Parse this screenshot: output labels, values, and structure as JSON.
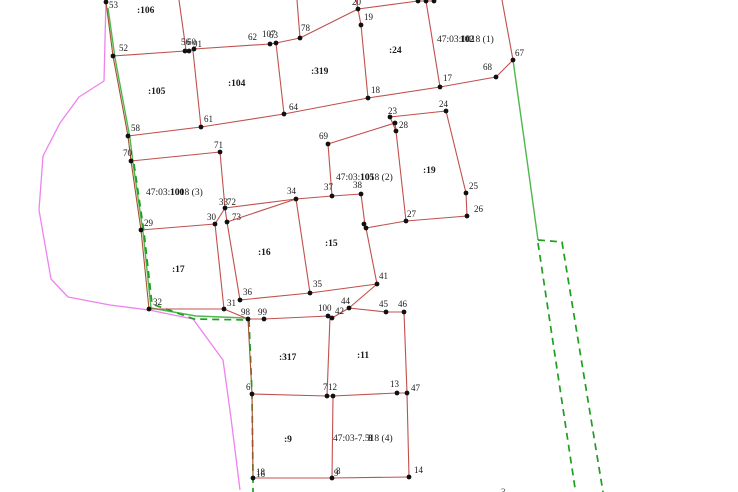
{
  "map": {
    "width": 738,
    "height": 492,
    "colors": {
      "parcel_line": "#c0504d",
      "parcel_line_brown": "#a85032",
      "vertex_dot": "#101010",
      "green_solid": "#4db84d",
      "green_dashed": "#1f9e1f",
      "magenta": "#ee82ee",
      "label_text": "#1a1a1a"
    },
    "red_polylines": [
      {
        "c": "brown",
        "pts": [
          [
            105,
            0
          ],
          [
            106,
            2
          ],
          [
            113,
            56
          ],
          [
            128,
            136
          ],
          [
            131,
            161
          ],
          [
            141,
            230
          ],
          [
            149,
            309
          ]
        ]
      },
      {
        "pts": [
          [
            113,
            56
          ],
          [
            185,
            51
          ],
          [
            189,
            51
          ],
          [
            194,
            49
          ],
          [
            270,
            44
          ],
          [
            276,
            43
          ],
          [
            300,
            38
          ],
          [
            358,
            9
          ],
          [
            361,
            25
          ],
          [
            368,
            98
          ],
          [
            440,
            87
          ],
          [
            496,
            77
          ],
          [
            513,
            60
          ]
        ]
      },
      {
        "pts": [
          [
            128,
            136
          ],
          [
            201,
            127
          ],
          [
            284,
            114
          ],
          [
            368,
            98
          ]
        ]
      },
      {
        "pts": [
          [
            193,
            51
          ],
          [
            201,
            127
          ]
        ]
      },
      {
        "pts": [
          [
            276,
            43
          ],
          [
            284,
            114
          ]
        ]
      },
      {
        "pts": [
          [
            186,
            50
          ],
          [
            179,
            0
          ]
        ]
      },
      {
        "pts": [
          [
            300,
            38
          ],
          [
            297,
            0
          ]
        ]
      },
      {
        "pts": [
          [
            358,
            9
          ],
          [
            356,
            0
          ]
        ]
      },
      {
        "pts": [
          [
            358,
            9
          ],
          [
            418,
            1
          ],
          [
            426,
            1
          ],
          [
            434,
            1
          ]
        ]
      },
      {
        "pts": [
          [
            426,
            1
          ],
          [
            440,
            87
          ]
        ]
      },
      {
        "pts": [
          [
            502,
            0
          ],
          [
            513,
            60
          ]
        ]
      },
      {
        "pts": [
          [
            131,
            161
          ],
          [
            220,
            152
          ],
          [
            225,
            208
          ],
          [
            227,
            222
          ]
        ]
      },
      {
        "pts": [
          [
            141,
            230
          ],
          [
            215,
            224
          ],
          [
            225,
            208
          ]
        ]
      },
      {
        "pts": [
          [
            215,
            224
          ],
          [
            224,
            309
          ]
        ]
      },
      {
        "pts": [
          [
            227,
            222
          ],
          [
            240,
            300
          ]
        ]
      },
      {
        "pts": [
          [
            225,
            208
          ],
          [
            296,
            199
          ]
        ]
      },
      {
        "pts": [
          [
            227,
            222
          ],
          [
            296,
            199
          ]
        ]
      },
      {
        "pts": [
          [
            296,
            199
          ],
          [
            310,
            293
          ]
        ]
      },
      {
        "pts": [
          [
            310,
            293
          ],
          [
            240,
            300
          ]
        ]
      },
      {
        "pts": [
          [
            149,
            309
          ],
          [
            224,
            309
          ],
          [
            248,
            319
          ]
        ]
      },
      {
        "pts": [
          [
            328,
            144
          ],
          [
            395,
            123
          ]
        ]
      },
      {
        "pts": [
          [
            395,
            123
          ],
          [
            396,
            131
          ]
        ]
      },
      {
        "pts": [
          [
            390,
            117
          ],
          [
            396,
            131
          ]
        ]
      },
      {
        "pts": [
          [
            390,
            117
          ],
          [
            446,
            111
          ],
          [
            466,
            193
          ],
          [
            467,
            216
          ],
          [
            406,
            221
          ],
          [
            366,
            228
          ]
        ]
      },
      {
        "pts": [
          [
            396,
            131
          ],
          [
            406,
            221
          ]
        ]
      },
      {
        "pts": [
          [
            328,
            144
          ],
          [
            332,
            196
          ],
          [
            361,
            194
          ],
          [
            365,
            225
          ]
        ]
      },
      {
        "pts": [
          [
            296,
            199
          ],
          [
            332,
            196
          ]
        ]
      },
      {
        "pts": [
          [
            310,
            293
          ],
          [
            377,
            284
          ],
          [
            349,
            308
          ]
        ]
      },
      {
        "pts": [
          [
            366,
            228
          ],
          [
            377,
            284
          ]
        ]
      },
      {
        "pts": [
          [
            248,
            319
          ],
          [
            264,
            319
          ],
          [
            328,
            316
          ],
          [
            332,
            318
          ],
          [
            349,
            308
          ],
          [
            386,
            312
          ],
          [
            404,
            312
          ]
        ]
      },
      {
        "pts": [
          [
            404,
            312
          ],
          [
            407,
            393
          ]
        ]
      },
      {
        "pts": [
          [
            330,
            317
          ],
          [
            327,
            396
          ]
        ]
      },
      {
        "c": "brown",
        "pts": [
          [
            248,
            319
          ],
          [
            252,
            394
          ],
          [
            253,
            478
          ]
        ]
      },
      {
        "pts": [
          [
            252,
            394
          ],
          [
            327,
            396
          ],
          [
            333,
            396
          ],
          [
            397,
            393
          ],
          [
            407,
            393
          ]
        ]
      },
      {
        "pts": [
          [
            253,
            478
          ],
          [
            332,
            478
          ],
          [
            409,
            477
          ]
        ]
      },
      {
        "pts": [
          [
            332,
            478
          ],
          [
            333,
            396
          ]
        ]
      },
      {
        "pts": [
          [
            409,
            477
          ],
          [
            407,
            393
          ]
        ]
      }
    ],
    "green_solid_polylines": [
      [
        [
          108,
          8
        ],
        [
          115,
          58
        ],
        [
          130,
          138
        ],
        [
          133,
          163
        ],
        [
          143,
          232
        ],
        [
          151,
          308
        ],
        [
          196,
          316
        ],
        [
          245,
          318
        ]
      ],
      [
        [
          513,
          60
        ],
        [
          527,
          160
        ],
        [
          538,
          240
        ]
      ]
    ],
    "green_dashed_polylines": [
      [
        [
          134,
          164
        ],
        [
          144,
          232
        ],
        [
          152,
          304
        ],
        [
          194,
          319
        ],
        [
          247,
          320
        ]
      ],
      [
        [
          249,
          320
        ],
        [
          252,
          394
        ],
        [
          253,
          478
        ],
        [
          253,
          492
        ]
      ],
      [
        [
          538,
          240
        ],
        [
          562,
          242
        ],
        [
          603,
          492
        ]
      ],
      [
        [
          538,
          243
        ],
        [
          575,
          488
        ]
      ]
    ],
    "magenta_polylines": [
      [
        [
          106,
          0
        ],
        [
          104,
          81
        ],
        [
          79,
          97
        ],
        [
          60,
          123
        ],
        [
          43,
          156
        ],
        [
          39,
          210
        ],
        [
          51,
          279
        ],
        [
          68,
          297
        ],
        [
          110,
          305
        ],
        [
          149,
          310
        ],
        [
          193,
          319
        ],
        [
          223,
          360
        ],
        [
          231,
          418
        ],
        [
          240,
          490
        ]
      ]
    ],
    "vertices": [
      [
        106,
        2
      ],
      [
        113,
        56
      ],
      [
        185,
        51
      ],
      [
        189,
        51
      ],
      [
        194,
        49
      ],
      [
        270,
        44
      ],
      [
        276,
        43
      ],
      [
        300,
        38
      ],
      [
        358,
        9
      ],
      [
        361,
        25
      ],
      [
        418,
        1
      ],
      [
        426,
        1
      ],
      [
        434,
        1
      ],
      [
        368,
        98
      ],
      [
        440,
        87
      ],
      [
        496,
        77
      ],
      [
        513,
        60
      ],
      [
        128,
        136
      ],
      [
        201,
        127
      ],
      [
        284,
        114
      ],
      [
        131,
        161
      ],
      [
        220,
        152
      ],
      [
        328,
        144
      ],
      [
        390,
        117
      ],
      [
        446,
        111
      ],
      [
        395,
        123
      ],
      [
        396,
        131
      ],
      [
        466,
        193
      ],
      [
        467,
        216
      ],
      [
        406,
        221
      ],
      [
        332,
        196
      ],
      [
        361,
        194
      ],
      [
        296,
        199
      ],
      [
        225,
        208
      ],
      [
        227,
        222
      ],
      [
        215,
        224
      ],
      [
        141,
        230
      ],
      [
        364,
        224
      ],
      [
        366,
        228
      ],
      [
        377,
        284
      ],
      [
        310,
        293
      ],
      [
        240,
        300
      ],
      [
        224,
        309
      ],
      [
        149,
        309
      ],
      [
        248,
        319
      ],
      [
        264,
        319
      ],
      [
        328,
        316
      ],
      [
        332,
        318
      ],
      [
        349,
        308
      ],
      [
        386,
        312
      ],
      [
        404,
        312
      ],
      [
        252,
        394
      ],
      [
        327,
        396
      ],
      [
        333,
        396
      ],
      [
        397,
        393
      ],
      [
        407,
        393
      ],
      [
        253,
        478
      ],
      [
        332,
        478
      ],
      [
        409,
        477
      ]
    ],
    "vertex_labels": [
      {
        "t": "53",
        "x": 109,
        "y": 8
      },
      {
        "t": "52",
        "x": 119,
        "y": 51
      },
      {
        "t": "56",
        "x": 181,
        "y": 45
      },
      {
        "t": "60",
        "x": 187,
        "y": 45
      },
      {
        "t": "91",
        "x": 193,
        "y": 47
      },
      {
        "t": "62",
        "x": 248,
        "y": 40
      },
      {
        "t": "107",
        "x": 262,
        "y": 37
      },
      {
        "t": "63",
        "x": 269,
        "y": 38
      },
      {
        "t": "78",
        "x": 301,
        "y": 31
      },
      {
        "t": "20",
        "x": 352,
        "y": 5
      },
      {
        "t": "19",
        "x": 364,
        "y": 20
      },
      {
        "t": "18",
        "x": 371,
        "y": 93
      },
      {
        "t": "17",
        "x": 443,
        "y": 81
      },
      {
        "t": "68",
        "x": 483,
        "y": 70
      },
      {
        "t": "67",
        "x": 515,
        "y": 56
      },
      {
        "t": "58",
        "x": 131,
        "y": 131
      },
      {
        "t": "61",
        "x": 204,
        "y": 122
      },
      {
        "t": "64",
        "x": 289,
        "y": 110
      },
      {
        "t": "70",
        "x": 123,
        "y": 156
      },
      {
        "t": "71",
        "x": 214,
        "y": 148
      },
      {
        "t": "69",
        "x": 319,
        "y": 139
      },
      {
        "t": "23",
        "x": 388,
        "y": 114
      },
      {
        "t": "24",
        "x": 439,
        "y": 107
      },
      {
        "t": "28",
        "x": 399,
        "y": 128
      },
      {
        "t": "25",
        "x": 469,
        "y": 189
      },
      {
        "t": "26",
        "x": 474,
        "y": 212
      },
      {
        "t": "27",
        "x": 407,
        "y": 217
      },
      {
        "t": "37",
        "x": 324,
        "y": 190
      },
      {
        "t": "38",
        "x": 353,
        "y": 188
      },
      {
        "t": "34",
        "x": 287,
        "y": 194
      },
      {
        "t": "33",
        "x": 219,
        "y": 205
      },
      {
        "t": "72",
        "x": 227,
        "y": 205
      },
      {
        "t": "73",
        "x": 232,
        "y": 220
      },
      {
        "t": "30",
        "x": 207,
        "y": 220
      },
      {
        "t": "29",
        "x": 144,
        "y": 226
      },
      {
        "t": "32",
        "x": 153,
        "y": 305
      },
      {
        "t": "31",
        "x": 227,
        "y": 306
      },
      {
        "t": "36",
        "x": 243,
        "y": 295
      },
      {
        "t": "35",
        "x": 313,
        "y": 287
      },
      {
        "t": "41",
        "x": 379,
        "y": 279
      },
      {
        "t": "98",
        "x": 241,
        "y": 315
      },
      {
        "t": "99",
        "x": 258,
        "y": 315
      },
      {
        "t": "100",
        "x": 318,
        "y": 311
      },
      {
        "t": "42",
        "x": 335,
        "y": 314
      },
      {
        "t": "44",
        "x": 341,
        "y": 304
      },
      {
        "t": "45",
        "x": 379,
        "y": 307
      },
      {
        "t": "46",
        "x": 398,
        "y": 307
      },
      {
        "t": "6",
        "x": 246,
        "y": 390
      },
      {
        "t": "7",
        "x": 323,
        "y": 390
      },
      {
        "t": "12",
        "x": 328,
        "y": 390
      },
      {
        "t": "13",
        "x": 390,
        "y": 387
      },
      {
        "t": "47",
        "x": 411,
        "y": 391
      },
      {
        "t": "16",
        "x": 256,
        "y": 477
      },
      {
        "t": "18",
        "x": 256,
        "y": 475
      },
      {
        "t": "8",
        "x": 336,
        "y": 474
      },
      {
        "t": "9",
        "x": 334,
        "y": 476
      },
      {
        "t": "14",
        "x": 414,
        "y": 473
      }
    ],
    "parcel_labels": [
      {
        "t": ":106",
        "x": 137,
        "y": 13
      },
      {
        "t": ":105",
        "x": 148,
        "y": 94
      },
      {
        "t": ":104",
        "x": 228,
        "y": 86
      },
      {
        "t": ":319",
        "x": 311,
        "y": 74
      },
      {
        "t": ":24",
        "x": 389,
        "y": 53
      },
      {
        "t": ":19",
        "x": 423,
        "y": 173
      },
      {
        "t": ":17",
        "x": 172,
        "y": 272
      },
      {
        "t": ":16",
        "x": 258,
        "y": 255
      },
      {
        "t": ":15",
        "x": 325,
        "y": 246
      },
      {
        "t": ":317",
        "x": 279,
        "y": 360
      },
      {
        "t": ":11",
        "x": 357,
        "y": 358
      },
      {
        "t": ":9",
        "x": 284,
        "y": 442
      }
    ],
    "cadastral_labels": [
      {
        "t": "47:03:1018 (1)",
        "o": "102",
        "x": 437,
        "y": 42,
        "ox": 460
      },
      {
        "t": "47:03:1018 (3)",
        "o": "100",
        "x": 146,
        "y": 195,
        "ox": 170
      },
      {
        "t": "47:03:1018 (2)",
        "o": "105",
        "x": 336,
        "y": 180,
        "ox": 360
      },
      {
        "t": "47:03-7.518 (4)",
        "o": "8",
        "x": 333,
        "y": 441,
        "ox": 368
      }
    ],
    "bottom_fragments": [
      {
        "t": "..",
        "x": 455,
        "y": 494
      },
      {
        "t": "3",
        "x": 501,
        "y": 495
      }
    ]
  }
}
